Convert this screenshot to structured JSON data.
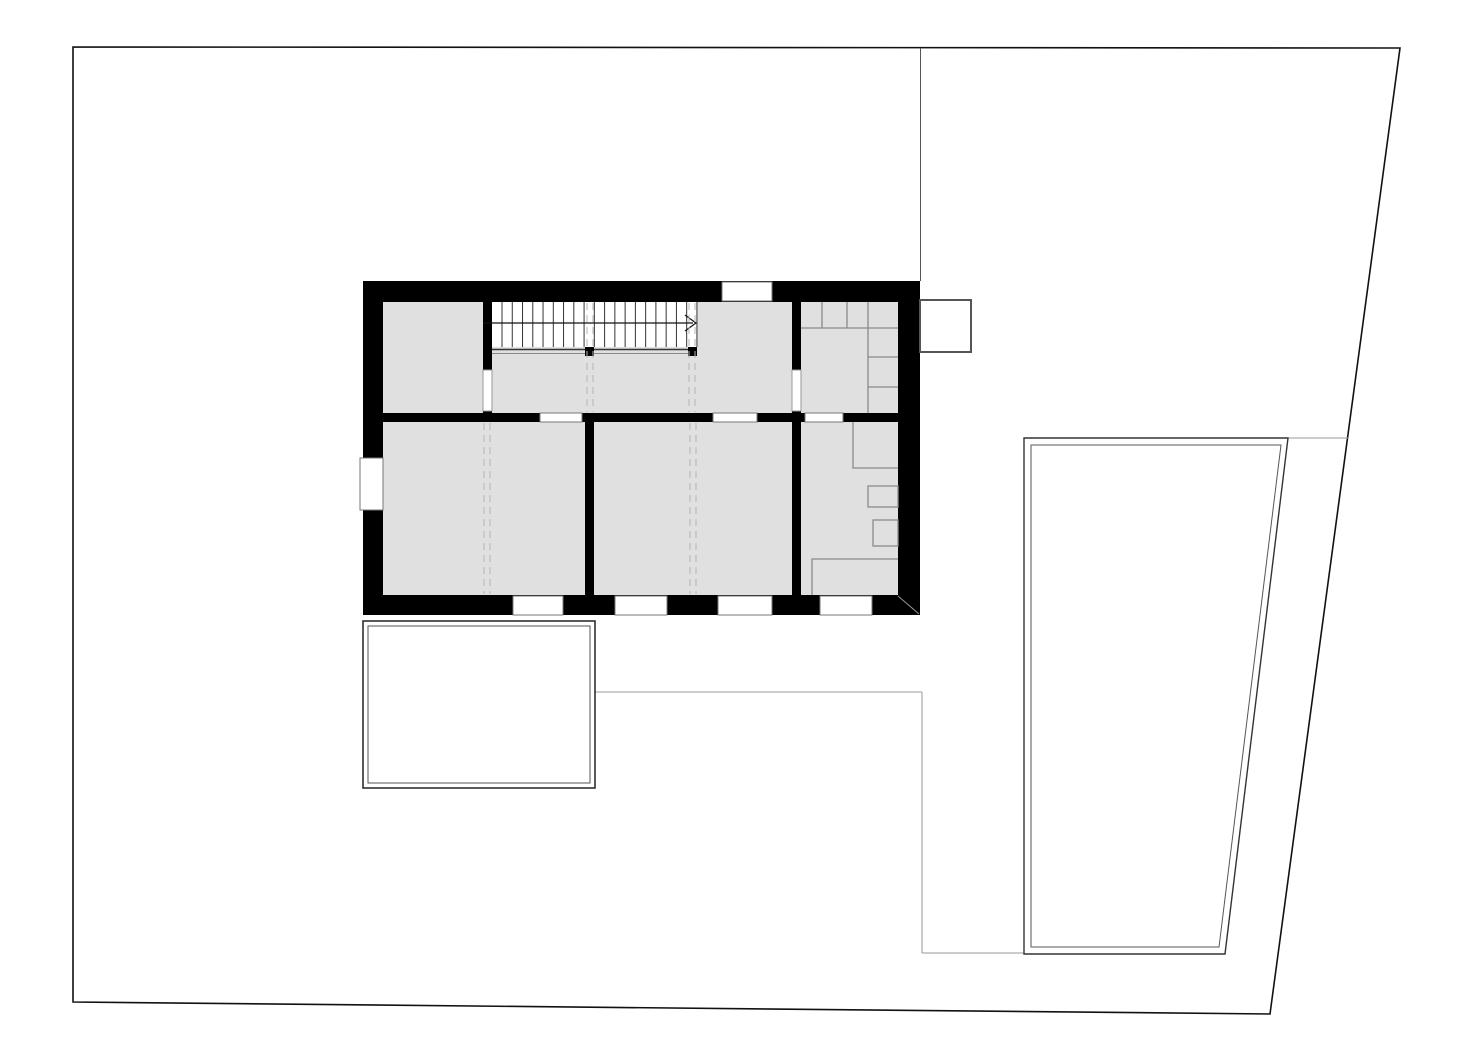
{
  "colors": {
    "paper": "#ffffff",
    "wall": "#000000",
    "room_fill": "#e0e0e0",
    "site_boundary": "#111111",
    "path_line": "#999999",
    "furniture_line": "#8a8a8a",
    "dashed_projection": "#b3b3b3",
    "stair_tread": "#333333",
    "window_frame": "#777777"
  },
  "plan": {
    "width": 1473,
    "height": 1064,
    "stair": {
      "tread_count": 20,
      "direction": "right"
    },
    "shapes": [
      {
        "name": "site-boundary",
        "type": "polygon",
        "points": [
          [
            73,
            47
          ],
          [
            1400,
            48
          ],
          [
            1270,
            1014
          ],
          [
            73,
            1002
          ]
        ],
        "fill": "#ffffff",
        "stroke": "#111111",
        "width": 1.6
      },
      {
        "name": "boundary-line-north",
        "type": "line",
        "x1": 920.5,
        "y1": 48,
        "x2": 920.5,
        "y2": 281,
        "stroke": "#555555",
        "width": 1
      },
      {
        "name": "walkway-edge-top",
        "type": "line",
        "x1": 595,
        "y1": 692,
        "x2": 922,
        "y2": 692,
        "stroke": "#999999",
        "width": 1
      },
      {
        "name": "walkway-edge-right",
        "type": "line",
        "x1": 922,
        "y1": 692,
        "x2": 922,
        "y2": 953,
        "stroke": "#999999",
        "width": 1
      },
      {
        "name": "walkway-edge-bottom",
        "type": "line",
        "x1": 922,
        "y1": 953,
        "x2": 1024,
        "y2": 953,
        "stroke": "#999999",
        "width": 1
      },
      {
        "name": "pool-access-line",
        "type": "line",
        "x1": 1288,
        "y1": 438,
        "x2": 1348,
        "y2": 438,
        "stroke": "#999999",
        "width": 1
      },
      {
        "name": "terrace-outer",
        "type": "rect",
        "x": 363,
        "y": 621,
        "w": 232,
        "h": 167,
        "fill": "#ffffff",
        "stroke": "#222222",
        "width": 1.5
      },
      {
        "name": "terrace-inner",
        "type": "rect",
        "x": 368,
        "y": 626,
        "w": 222,
        "h": 157,
        "fill": "none",
        "stroke": "#555555",
        "width": 1
      },
      {
        "name": "pool-outer",
        "type": "polygon",
        "points": [
          [
            1024,
            438
          ],
          [
            1288,
            438
          ],
          [
            1225,
            954
          ],
          [
            1024,
            954
          ]
        ],
        "fill": "#ffffff",
        "stroke": "#333333",
        "width": 1.4
      },
      {
        "name": "pool-inner",
        "type": "polygon",
        "points": [
          [
            1031,
            445
          ],
          [
            1281,
            445
          ],
          [
            1219,
            947
          ],
          [
            1031,
            947
          ]
        ],
        "fill": "none",
        "stroke": "#555555",
        "width": 1
      },
      {
        "name": "building-walls",
        "type": "rect",
        "x": 363,
        "y": 281,
        "w": 557,
        "h": 334,
        "fill": "#000000"
      },
      {
        "name": "annex-box",
        "type": "rect",
        "x": 920,
        "y": 300,
        "w": 51,
        "h": 52,
        "fill": "#ffffff",
        "stroke": "#555555",
        "width": 2
      },
      {
        "name": "room-upper-left",
        "type": "rect",
        "x": 383,
        "y": 302,
        "w": 100,
        "h": 111,
        "fill": "#e0e0e0"
      },
      {
        "name": "room-hall",
        "type": "rect",
        "x": 492,
        "y": 302,
        "w": 300,
        "h": 111,
        "fill": "#e0e0e0"
      },
      {
        "name": "room-upper-right",
        "type": "rect",
        "x": 801,
        "y": 302,
        "w": 97,
        "h": 111,
        "fill": "#e0e0e0"
      },
      {
        "name": "room-lower-left",
        "type": "rect",
        "x": 383,
        "y": 422,
        "w": 202,
        "h": 173,
        "fill": "#e0e0e0"
      },
      {
        "name": "room-lower-middle",
        "type": "rect",
        "x": 594,
        "y": 422,
        "w": 198,
        "h": 173,
        "fill": "#e0e0e0"
      },
      {
        "name": "room-lower-right",
        "type": "rect",
        "x": 801,
        "y": 422,
        "w": 97,
        "h": 173,
        "fill": "#e0e0e0"
      },
      {
        "name": "stair-well",
        "type": "rect",
        "x": 492,
        "y": 302,
        "w": 205,
        "h": 45,
        "fill": "#ffffff"
      },
      {
        "name": "stair-treads",
        "type": "vlines",
        "x0": 502,
        "step": 10.26,
        "n": 20,
        "y1": 302,
        "y2": 347,
        "stroke": "#333333",
        "width": 1
      },
      {
        "name": "stair-edge-line",
        "type": "line",
        "x1": 492,
        "y1": 349.5,
        "x2": 697,
        "y2": 349.5,
        "stroke": "#333333",
        "width": 1.4
      },
      {
        "name": "stair-edge-line-2",
        "type": "line",
        "x1": 492,
        "y1": 353.5,
        "x2": 697,
        "y2": 353.5,
        "stroke": "#888888",
        "width": 1
      },
      {
        "name": "stair-direction-line",
        "type": "line",
        "x1": 483,
        "y1": 323,
        "x2": 693,
        "y2": 323,
        "stroke": "#111111",
        "width": 1.2
      },
      {
        "name": "stair-direction-arrow",
        "type": "polyline",
        "points": [
          [
            685,
            315
          ],
          [
            696,
            323
          ],
          [
            685,
            331
          ]
        ],
        "fill": "none",
        "stroke": "#111111",
        "width": 1.2
      },
      {
        "name": "stair-post-left",
        "type": "rect",
        "x": 585,
        "y": 347,
        "w": 9,
        "h": 9,
        "fill": "#000000"
      },
      {
        "name": "stair-post-right",
        "type": "rect",
        "x": 688,
        "y": 347,
        "w": 9,
        "h": 9,
        "fill": "#000000"
      },
      {
        "name": "projection-line-1a",
        "type": "line",
        "x1": 587,
        "y1": 303,
        "x2": 587,
        "y2": 412,
        "stroke": "#b3b3b3",
        "width": 1,
        "dash": "7 5"
      },
      {
        "name": "projection-line-1b",
        "type": "line",
        "x1": 593,
        "y1": 303,
        "x2": 593,
        "y2": 412,
        "stroke": "#b3b3b3",
        "width": 1,
        "dash": "7 5"
      },
      {
        "name": "projection-line-2a",
        "type": "line",
        "x1": 689,
        "y1": 303,
        "x2": 689,
        "y2": 412,
        "stroke": "#b3b3b3",
        "width": 1,
        "dash": "7 5"
      },
      {
        "name": "projection-line-2b",
        "type": "line",
        "x1": 695,
        "y1": 303,
        "x2": 695,
        "y2": 412,
        "stroke": "#b3b3b3",
        "width": 1,
        "dash": "7 5"
      },
      {
        "name": "projection-line-3a",
        "type": "line",
        "x1": 484,
        "y1": 423,
        "x2": 484,
        "y2": 594,
        "stroke": "#b3b3b3",
        "width": 1,
        "dash": "7 5"
      },
      {
        "name": "projection-line-3b",
        "type": "line",
        "x1": 490,
        "y1": 423,
        "x2": 490,
        "y2": 594,
        "stroke": "#b3b3b3",
        "width": 1,
        "dash": "7 5"
      },
      {
        "name": "projection-line-4a",
        "type": "line",
        "x1": 690,
        "y1": 423,
        "x2": 690,
        "y2": 594,
        "stroke": "#b3b3b3",
        "width": 1,
        "dash": "7 5"
      },
      {
        "name": "projection-line-4b",
        "type": "line",
        "x1": 696,
        "y1": 423,
        "x2": 696,
        "y2": 594,
        "stroke": "#b3b3b3",
        "width": 1,
        "dash": "7 5"
      },
      {
        "name": "closet-shelf-line-h",
        "type": "line",
        "x1": 801,
        "y1": 328,
        "x2": 898,
        "y2": 328,
        "stroke": "#8a8a8a",
        "width": 1.3
      },
      {
        "name": "closet-divider-1",
        "type": "line",
        "x1": 822,
        "y1": 302,
        "x2": 822,
        "y2": 328,
        "stroke": "#8a8a8a",
        "width": 1.3
      },
      {
        "name": "closet-divider-2",
        "type": "line",
        "x1": 847,
        "y1": 302,
        "x2": 847,
        "y2": 328,
        "stroke": "#8a8a8a",
        "width": 1.3
      },
      {
        "name": "closet-side-line",
        "type": "line",
        "x1": 868,
        "y1": 302,
        "x2": 868,
        "y2": 413,
        "stroke": "#8a8a8a",
        "width": 1.3
      },
      {
        "name": "closet-shelf-1",
        "type": "line",
        "x1": 868,
        "y1": 357,
        "x2": 898,
        "y2": 357,
        "stroke": "#8a8a8a",
        "width": 1.3
      },
      {
        "name": "closet-shelf-2",
        "type": "line",
        "x1": 868,
        "y1": 387,
        "x2": 898,
        "y2": 387,
        "stroke": "#8a8a8a",
        "width": 1.3
      },
      {
        "name": "bath-shower-outline",
        "type": "polyline",
        "points": [
          [
            853,
            422
          ],
          [
            853,
            468
          ],
          [
            898,
            468
          ]
        ],
        "fill": "none",
        "stroke": "#8a8a8a",
        "width": 1.3
      },
      {
        "name": "bath-sink-outline",
        "type": "rect",
        "x": 868,
        "y": 486,
        "w": 30,
        "h": 21,
        "fill": "none",
        "stroke": "#8a8a8a",
        "width": 1.3
      },
      {
        "name": "bath-wc-outline",
        "type": "rect",
        "x": 873,
        "y": 520,
        "w": 25,
        "h": 26,
        "fill": "none",
        "stroke": "#8a8a8a",
        "width": 1.3
      },
      {
        "name": "bath-tub-outline",
        "type": "polyline",
        "points": [
          [
            812,
            595
          ],
          [
            812,
            559
          ],
          [
            898,
            559
          ]
        ],
        "fill": "none",
        "stroke": "#8a8a8a",
        "width": 1.3
      },
      {
        "name": "wall-corner-diagonal",
        "type": "line",
        "x1": 898,
        "y1": 596,
        "x2": 919,
        "y2": 614,
        "stroke": "#999999",
        "width": 1
      },
      {
        "name": "door-opening-upper-left",
        "type": "rect",
        "x": 483,
        "y": 370,
        "w": 9,
        "h": 41,
        "fill": "#ffffff",
        "stroke": "#999999",
        "width": 1
      },
      {
        "name": "door-opening-upper-right",
        "type": "rect",
        "x": 792,
        "y": 370,
        "w": 9,
        "h": 41,
        "fill": "#ffffff",
        "stroke": "#999999",
        "width": 1
      },
      {
        "name": "interior-window-1",
        "type": "rect",
        "x": 540,
        "y": 413,
        "w": 42,
        "h": 9,
        "fill": "#ffffff",
        "stroke": "#777777",
        "width": 1
      },
      {
        "name": "interior-window-2",
        "type": "rect",
        "x": 713,
        "y": 413,
        "w": 44,
        "h": 9,
        "fill": "#ffffff",
        "stroke": "#777777",
        "width": 1
      },
      {
        "name": "interior-window-3",
        "type": "rect",
        "x": 805,
        "y": 413,
        "w": 38,
        "h": 9,
        "fill": "#ffffff",
        "stroke": "#777777",
        "width": 1
      },
      {
        "name": "window-north",
        "type": "rect",
        "x": 722,
        "y": 282,
        "w": 50,
        "h": 19,
        "fill": "#ffffff",
        "stroke": "#777777",
        "width": 1
      },
      {
        "name": "window-west",
        "type": "rect",
        "x": 360,
        "y": 458,
        "w": 23,
        "h": 52,
        "fill": "#ffffff",
        "stroke": "#777777",
        "width": 1
      },
      {
        "name": "window-south-1",
        "type": "rect",
        "x": 513,
        "y": 596,
        "w": 50,
        "h": 19,
        "fill": "#ffffff",
        "stroke": "#777777",
        "width": 1
      },
      {
        "name": "window-south-2",
        "type": "rect",
        "x": 615,
        "y": 596,
        "w": 52,
        "h": 19,
        "fill": "#ffffff",
        "stroke": "#777777",
        "width": 1
      },
      {
        "name": "window-south-3",
        "type": "rect",
        "x": 718,
        "y": 596,
        "w": 54,
        "h": 19,
        "fill": "#ffffff",
        "stroke": "#777777",
        "width": 1
      },
      {
        "name": "window-south-4",
        "type": "rect",
        "x": 820,
        "y": 596,
        "w": 52,
        "h": 19,
        "fill": "#ffffff",
        "stroke": "#777777",
        "width": 1
      }
    ]
  }
}
